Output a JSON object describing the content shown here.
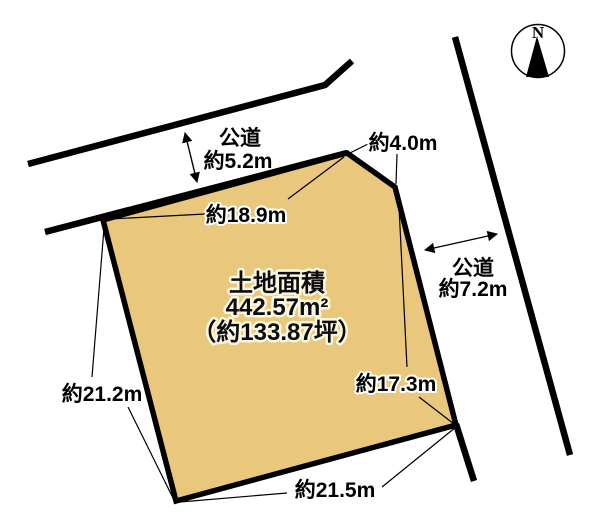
{
  "diagram_title": "land-plot-survey-diagram",
  "compass": {
    "label": "N"
  },
  "parcel": {
    "fill_color": "#e9c87d",
    "line_color": "#000000",
    "area_title": "土地面積",
    "area_m2": "442.57m²",
    "area_tsubo": "（約133.87坪）"
  },
  "roads": {
    "top": {
      "name": "公道",
      "width": "約5.2m"
    },
    "right": {
      "name": "公道",
      "width": "約7.2m"
    }
  },
  "dimensions": {
    "top_edge": "約18.9m",
    "corner_cut_edge": "約4.0m",
    "right_edge": "約17.3m",
    "left_edge": "約21.2m",
    "bottom_edge": "約21.5m"
  }
}
